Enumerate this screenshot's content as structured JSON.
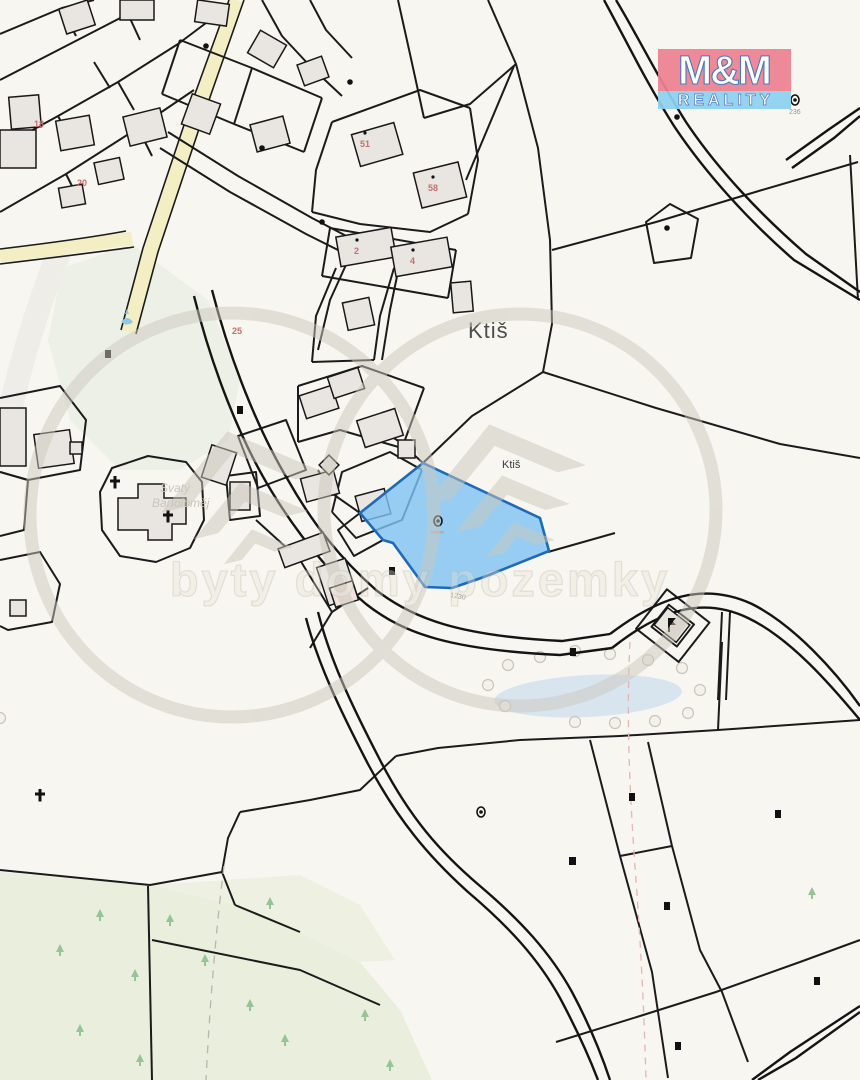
{
  "map": {
    "place_label_large": "Ktiš",
    "place_label_small": "Ktiš",
    "church_label_line1": "Svatý",
    "church_label_line2": "Bartoloměj",
    "road_parcel_number": "1230",
    "parcel_number_small": "236",
    "house_numbers": [
      {
        "value": "51"
      },
      {
        "value": "58"
      },
      {
        "value": "2"
      },
      {
        "value": "4"
      },
      {
        "value": "20"
      },
      {
        "value": "25"
      },
      {
        "value": "18"
      }
    ],
    "colors": {
      "background": "#f8f6f0",
      "parcel_line": "#1b1b1b",
      "building_fill": "#e9e6e1",
      "road_yellow": "#f3eec3",
      "forest_green": "#e9eedd",
      "pond_blue": "#d9e5ee",
      "highlight_fill": "#7ec3f2",
      "highlight_stroke": "#1f6ab8",
      "house_number_red": "#c76e6e",
      "dashed_pink": "#e4b5b5"
    }
  },
  "watermark": {
    "text": "byty domy pozemky"
  },
  "logo": {
    "title": "M&M",
    "subtitle": "REALITY",
    "top_bg": "#ee8292",
    "bottom_bg": "#8ed2f0"
  }
}
